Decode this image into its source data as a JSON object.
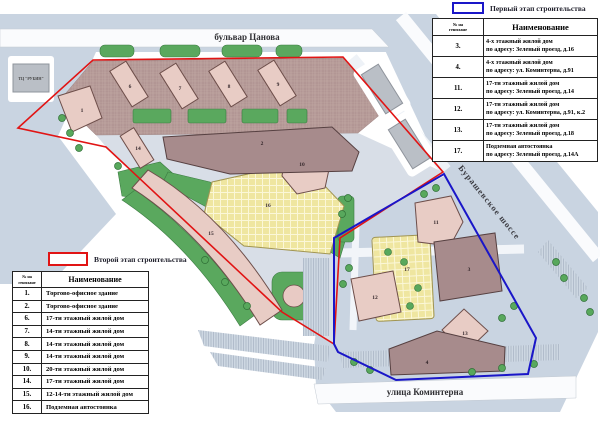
{
  "legend_first": {
    "label": "Первый этап строительства"
  },
  "legend_second": {
    "label": "Второй этап строительства"
  },
  "first_stage_table": {
    "header": {
      "num1": "№ на",
      "num2": "генплане",
      "name": "Наименование"
    },
    "rows": [
      {
        "num": "3.",
        "l1": "4-х этажный жилой дом",
        "l2": "по адресу: Зеленый проезд, д.16"
      },
      {
        "num": "4.",
        "l1": "4-х этажный жилой дом",
        "l2": "по адресу: ул. Коминтерна, д.91"
      },
      {
        "num": "11.",
        "l1": "17-ти этажный жилой дом",
        "l2": "по адресу: Зеленый проезд, д.14"
      },
      {
        "num": "12.",
        "l1": "17-ти этажный жилой дом",
        "l2": "по адресу: ул. Коминтерна, д.91, к.2"
      },
      {
        "num": "13.",
        "l1": "17-ти этажный жилой дом",
        "l2": "по адресу: Зеленый проезд, д.18"
      },
      {
        "num": "17.",
        "l1": "Подземная автостоянка",
        "l2": "по адресу: Зеленый проезд, д.14А"
      }
    ]
  },
  "second_stage_table": {
    "header": {
      "num1": "№ на",
      "num2": "генплане",
      "name": "Наименование"
    },
    "rows": [
      {
        "num": "1.",
        "name": "Торгово-офисное здание"
      },
      {
        "num": "2.",
        "name": "Торгово-офисное здание"
      },
      {
        "num": "6.",
        "name": "17-ти этажный жилой дом"
      },
      {
        "num": "7.",
        "name": "14-ти этажный жилой дом"
      },
      {
        "num": "8.",
        "name": "14-ти этажный жилой дом"
      },
      {
        "num": "9.",
        "name": "14-ти этажный жилой дом"
      },
      {
        "num": "10.",
        "name": "20-ти этажный жилой дом"
      },
      {
        "num": "14.",
        "name": "17-ти этажный жилой дом"
      },
      {
        "num": "15.",
        "name": "12-14-ти этажный жилой дом"
      },
      {
        "num": "16.",
        "name": "Подземная автостоянка"
      }
    ]
  },
  "map": {
    "street_top": "бульвар Цанова",
    "street_bottom": "улица Коминтерна",
    "street_right": "Бурашевское шоссе",
    "existing_building": "ТЦ \"РУБИН\"",
    "numbers": {
      "n1": "1",
      "n2": "2",
      "n3": "3",
      "n4": "4",
      "n6": "6",
      "n7": "7",
      "n8": "8",
      "n9": "9",
      "n10": "10",
      "n11": "11",
      "n12": "12",
      "n13": "13",
      "n14": "14",
      "n15": "15",
      "n16": "16",
      "n17": "17"
    }
  },
  "colors": {
    "first_stage_outline": "#1a16c8",
    "second_stage_outline": "#e11414"
  }
}
